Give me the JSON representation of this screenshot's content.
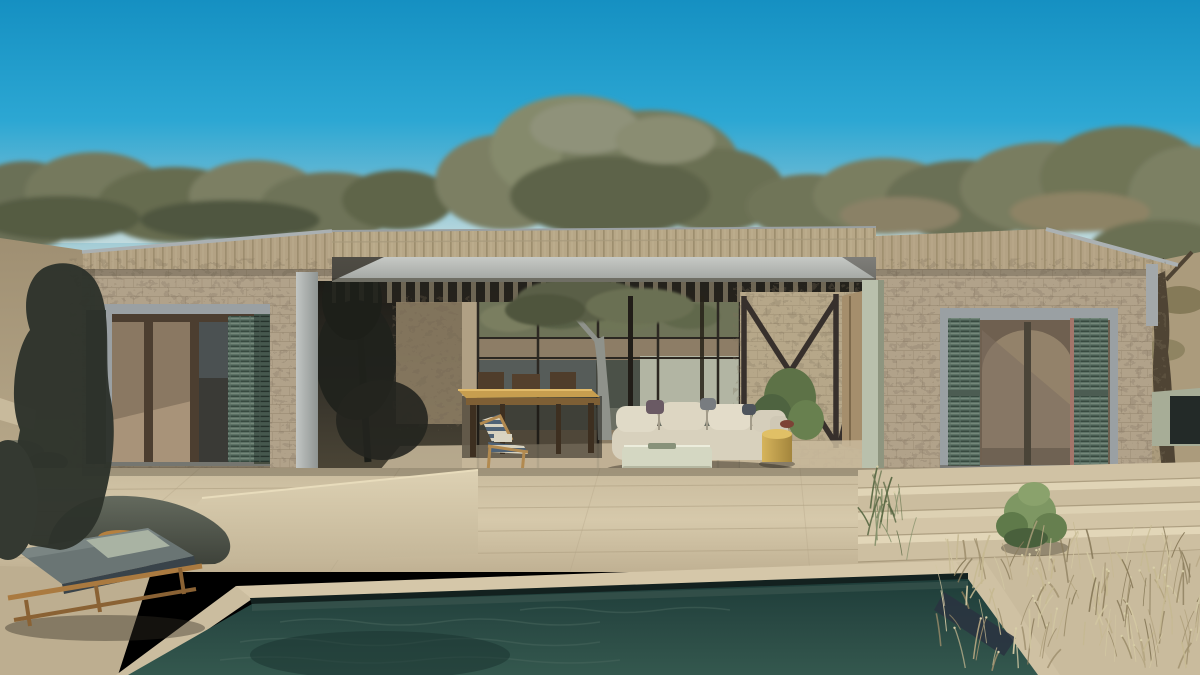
{
  "scene": {
    "description": "Photorealistic daylight exterior render of a single-storey Mediterranean stone villa: central covered patio with dining table, cream modular sofa, sage ottoman and yellow side table; large openings with green louvered shutters on both stone wings; tan tiled roof with a light concrete fascia and dark pergola slats; stone terrace with wide steps at right; dark teal swimming pool in the foreground; wooden sun lounger with grey-green cushion at left; olive trees behind the house and dry grasses at lower right under a clear cyan-blue sky.",
    "setting": "outdoor, clear sky, midday sun"
  },
  "objects": [
    "sky",
    "olive-tree-line",
    "stone-villa",
    "tiled-roof",
    "concrete-fascia",
    "pergola-slats",
    "covered-patio",
    "glass-back-wall",
    "interior-tree",
    "dining-table",
    "dining-chairs",
    "modular-sofa",
    "ottoman",
    "yellow-side-table",
    "deck-chair",
    "timber-braces",
    "open-timber-door",
    "left-window-green-shutters",
    "right-window-green-shutters",
    "stone-terrace",
    "terrace-steps",
    "swimming-pool",
    "pool-coping",
    "sun-lounger",
    "boulder",
    "dark-tree-silhouette",
    "succulent-bush",
    "dry-grass",
    "olive-tree-right",
    "hillside"
  ],
  "colors": {
    "sky_top": "#1590c2",
    "sky_mid": "#2ca7d3",
    "sky_low": "#7fc0d4",
    "sky_horizon": "#bcd5d8",
    "tree_dark": "#555b43",
    "tree_mid": "#6e7357",
    "tree_light": "#858a6c",
    "tree_khaki": "#8a8166",
    "roof_tile": "#b3a284",
    "roof_groove": "#8c7d5d",
    "roof_trim": "#aab0b2",
    "fascia": "#b9bcba",
    "stone": "#b1a28a",
    "stone_dark": "#7b6d57",
    "frame_gray": "#9aa0a3",
    "shutter_green": "#5d7266",
    "shutter_dark": "#46584e",
    "patio_shadow": "#2a2721",
    "panel_sage": "#b2b5a3",
    "interior_tan": "#8d7d66",
    "terrace": "#d4c7a9",
    "terrace_shade": "#bfb093",
    "pool_water": "#2a4a44",
    "waterline": "#13211f",
    "coping": "#d5c7a9",
    "wood_table": "#c79e4f",
    "sofa_cream": "#d8d1bd",
    "ottoman_sage": "#d4d7c2",
    "side_table_yellow": "#c8a84e",
    "lounger_cushion": "#6a7574",
    "lounger_wood": "#aa7a40",
    "rock_gray": "#5f645a",
    "succulent_green": "#7e9763",
    "grass_dry": "#b3a480"
  },
  "grass": {
    "count": 150,
    "palette": [
      "#c6b992",
      "#b3a480",
      "#9b8c6a",
      "#8a7c5c",
      "#d2c7a2"
    ],
    "region": {
      "x": 938,
      "y": 556,
      "w": 260,
      "h": 116
    },
    "tuft": {
      "count": 22,
      "palette": [
        "#6f7b55",
        "#5c6a46",
        "#84906b"
      ],
      "region": {
        "x": 862,
        "y": 505,
        "w": 46,
        "h": 55
      }
    }
  }
}
